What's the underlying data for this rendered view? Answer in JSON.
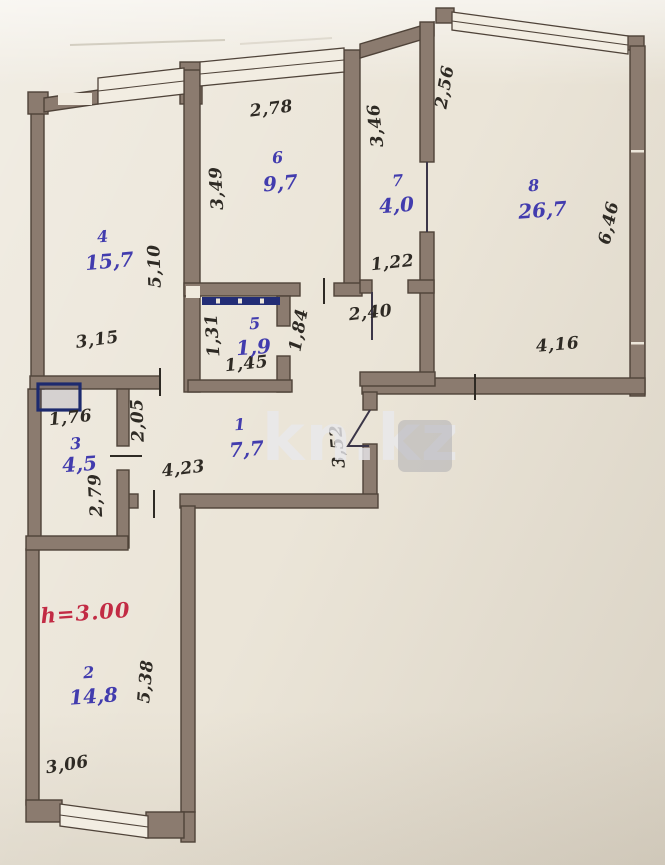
{
  "watermark": {
    "text": "kn.kz"
  },
  "height_note": {
    "text": "h=3.00"
  },
  "rooms": [
    {
      "number": "1",
      "area": "7,7"
    },
    {
      "number": "2",
      "area": "14,8"
    },
    {
      "number": "3",
      "area": "4,5"
    },
    {
      "number": "4",
      "area": "15,7"
    },
    {
      "number": "5",
      "area": "1,9"
    },
    {
      "number": "6",
      "area": "9,7"
    },
    {
      "number": "7",
      "area": "4,0"
    },
    {
      "number": "8",
      "area": "26,7"
    }
  ],
  "dimensions": [
    {
      "label": "2,78"
    },
    {
      "label": "3,49"
    },
    {
      "label": "5,10"
    },
    {
      "label": "3,15"
    },
    {
      "label": "3,46"
    },
    {
      "label": "2,56"
    },
    {
      "label": "6,46"
    },
    {
      "label": "1,22"
    },
    {
      "label": "2,40"
    },
    {
      "label": "1,31"
    },
    {
      "label": "1,45"
    },
    {
      "label": "1,84"
    },
    {
      "label": "4,16"
    },
    {
      "label": "1,76"
    },
    {
      "label": "2,05"
    },
    {
      "label": "3,52"
    },
    {
      "label": "4,23"
    },
    {
      "label": "2,79"
    },
    {
      "label": "5,38"
    },
    {
      "label": "3,06"
    }
  ],
  "colors": {
    "wall": "#8b7b6f",
    "wall_outline": "#4f4339",
    "paper": "#ebe5d8",
    "room_label": "#423cae",
    "dimension_text": "#2e2a24",
    "accent_navy": "#1d2a6e",
    "height_note_red": "#c22b44",
    "watermark_gray": "#e9e9ec"
  }
}
